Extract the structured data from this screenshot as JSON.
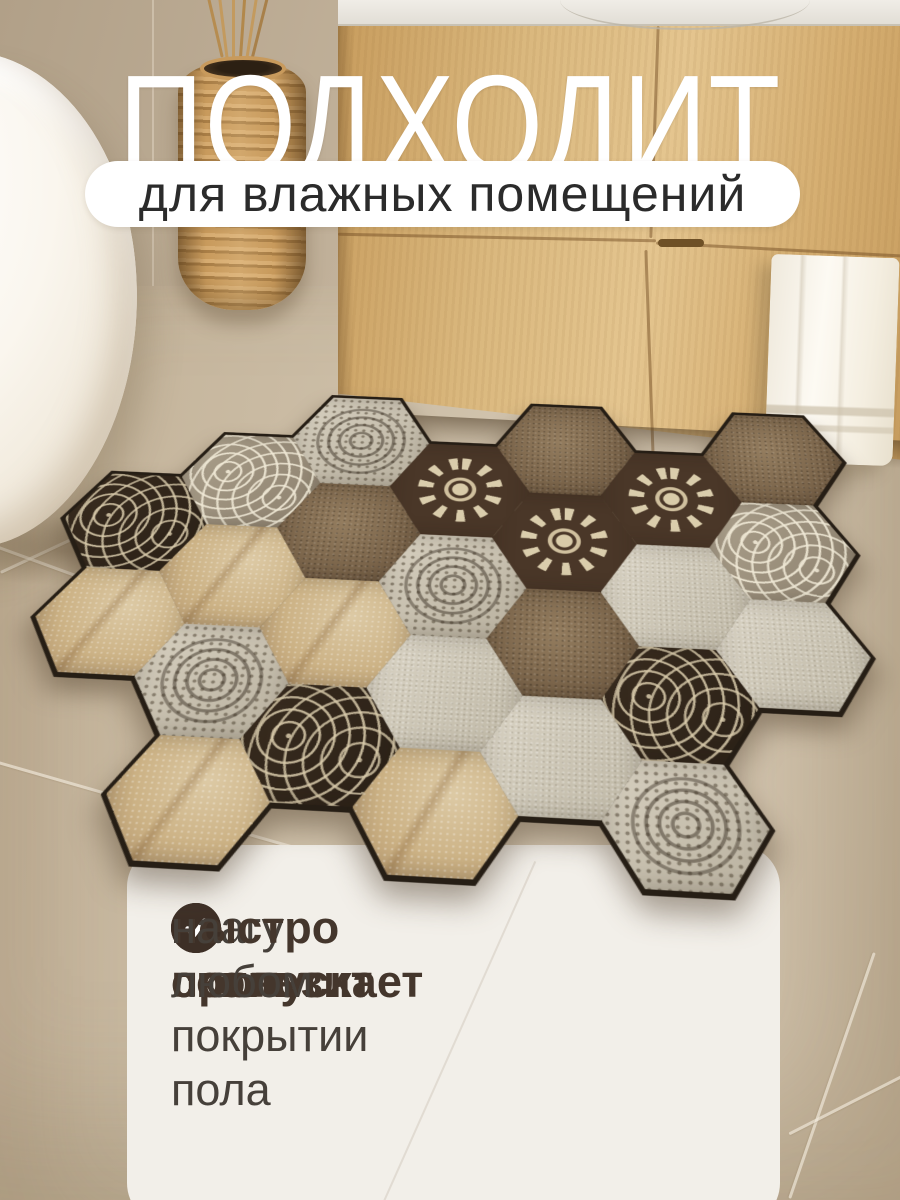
{
  "badge": {
    "title": "ПОДХОДИТ",
    "subtitle": "для влажных помещений"
  },
  "checklist": {
    "items": [
      {
        "bold": "не пропускает",
        "rest": " влагу"
      },
      {
        "bold": "быстро сохнет",
        "rest": ""
      },
      {
        "bold": "не скользит",
        "rest": " на любом покрытии пола"
      }
    ]
  },
  "colors": {
    "title": "#ffffff",
    "pill_bg": "#ffffff",
    "pill_text": "#2b2b2b",
    "card_bg": "#f2efe9",
    "check": "#3d2f26",
    "bold_text": "#44362c",
    "body_text": "#46403a",
    "mat_base": "#261e15",
    "wood_hex": "#32271c",
    "stone_hex": "#ccb285",
    "floor": "#cdbfa8",
    "cabinet_wood": "#dab87e"
  },
  "mat": {
    "tiles": [
      {
        "c": 0,
        "r": 1,
        "p": "wood"
      },
      {
        "c": 0,
        "r": 2,
        "p": "stone"
      },
      {
        "c": 1,
        "r": 0,
        "p": "woodlight"
      },
      {
        "c": 1,
        "r": 1,
        "p": "stone"
      },
      {
        "c": 1,
        "r": 2,
        "p": "lace"
      },
      {
        "c": 1,
        "r": 3,
        "p": "stone"
      },
      {
        "c": 2,
        "r": 0,
        "p": "lace"
      },
      {
        "c": 2,
        "r": 1,
        "p": "stonedark"
      },
      {
        "c": 2,
        "r": 2,
        "p": "stone"
      },
      {
        "c": 2,
        "r": 3,
        "p": "wood"
      },
      {
        "c": 3,
        "r": 0,
        "p": "mandala"
      },
      {
        "c": 3,
        "r": 1,
        "p": "lace"
      },
      {
        "c": 3,
        "r": 2,
        "p": "plain"
      },
      {
        "c": 3,
        "r": 3,
        "p": "stone"
      },
      {
        "c": 4,
        "r": 0,
        "p": "stonedark"
      },
      {
        "c": 4,
        "r": 1,
        "p": "mandala"
      },
      {
        "c": 4,
        "r": 2,
        "p": "stonedark"
      },
      {
        "c": 4,
        "r": 3,
        "p": "plain"
      },
      {
        "c": 5,
        "r": 0,
        "p": "mandala"
      },
      {
        "c": 5,
        "r": 1,
        "p": "plain"
      },
      {
        "c": 5,
        "r": 2,
        "p": "wood"
      },
      {
        "c": 5,
        "r": 3,
        "p": "lace"
      },
      {
        "c": 6,
        "r": 0,
        "p": "stonedark"
      },
      {
        "c": 6,
        "r": 1,
        "p": "woodlight"
      },
      {
        "c": 6,
        "r": 2,
        "p": "plain"
      }
    ]
  }
}
